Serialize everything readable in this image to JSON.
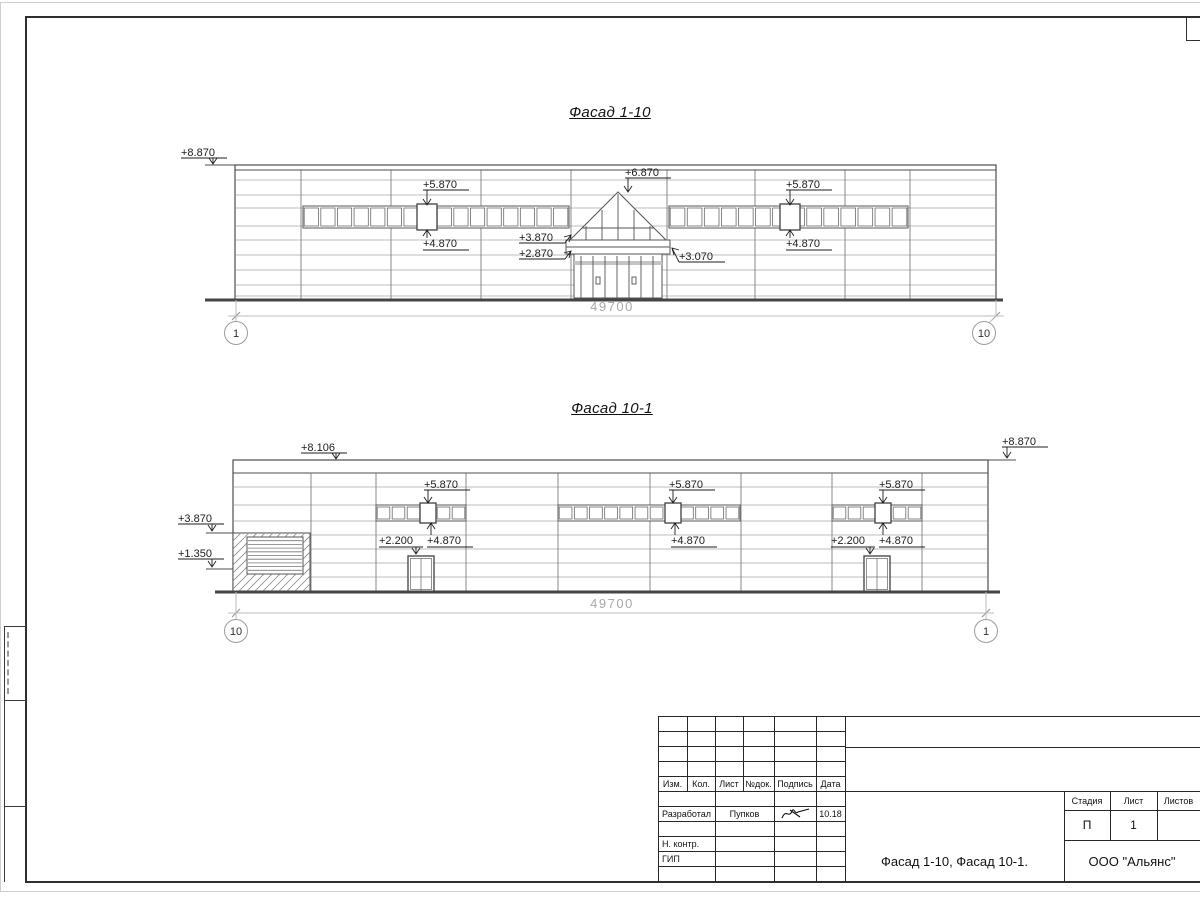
{
  "facade1": {
    "id": "1-10",
    "title": "Фасад 1-10",
    "dim_text": "49700",
    "axis_left": "1",
    "axis_right": "10",
    "wall": {
      "x1": 235,
      "y1": 165,
      "x2": 996,
      "y2": 300
    },
    "parapet_lines": [
      170
    ],
    "hlines": [
      180,
      195,
      208,
      226,
      240,
      255,
      270,
      285,
      296
    ],
    "vlines": [
      301,
      391,
      481,
      571,
      667,
      755,
      845,
      910
    ],
    "vtop": 170,
    "strips": [
      {
        "x1": 303,
        "x2": 569,
        "y1": 206,
        "y2": 228,
        "n": 16,
        "marked": 427
      },
      {
        "x1": 669,
        "x2": 908,
        "y1": 206,
        "y2": 228,
        "n": 14,
        "marked": 790
      }
    ],
    "entrance": {
      "apex": [
        618,
        192
      ],
      "baseY": 240,
      "baseX1": 570,
      "baseX2": 666,
      "canopy": [
        566,
        240,
        670,
        254
      ],
      "canopyLine": 247,
      "store": [
        574,
        254,
        662,
        298
      ],
      "transom": [
        574,
        261,
        662,
        265
      ],
      "mullions": [
        581,
        593,
        605,
        617,
        629,
        641,
        653
      ],
      "handles": [
        [
          596,
          277
        ],
        [
          632,
          277
        ]
      ],
      "glazeVerts": [
        586,
        602,
        618,
        634,
        650
      ],
      "glazeHorizY": 228
    },
    "ground": {
      "x1": 205,
      "x2": 1003,
      "y": 300
    },
    "dim": {
      "y": 316,
      "x1": 236,
      "x2": 996,
      "tx": 612,
      "ty": 311
    },
    "axes": [
      {
        "label": "1",
        "cx": 236,
        "cy": 333,
        "ext": [
          236,
          300,
          236,
          321
        ]
      },
      {
        "label": "10",
        "cx": 984,
        "cy": 333,
        "ext": [
          996,
          300,
          996,
          316
        ],
        "diag": [
          996,
          316,
          987,
          325
        ]
      }
    ],
    "stubs": [
      [
        205,
        165,
        235,
        165
      ]
    ],
    "markers": [
      {
        "label": "+8.870",
        "tx": 181,
        "ty": 156,
        "u": [
          181,
          227,
          158
        ],
        "ax": 213,
        "tip": 164,
        "dir": "down"
      },
      {
        "label": "+5.870",
        "tx": 423,
        "ty": 188,
        "u": [
          423,
          469,
          190
        ],
        "ax": 427,
        "tip": 205,
        "dir": "down"
      },
      {
        "label": "+4.870",
        "tx": 423,
        "ty": 247,
        "u": [
          423,
          469,
          250
        ],
        "ax": 427,
        "tip": 230,
        "dir": "up"
      },
      {
        "label": "+6.870",
        "tx": 625,
        "ty": 176,
        "u": [
          625,
          671,
          178
        ],
        "ax": 628,
        "tip": 192,
        "dir": "down"
      },
      {
        "label": "+3.870",
        "tx": 519,
        "ty": 241,
        "u": [
          519,
          565,
          243
        ],
        "tip": [
          571,
          235
        ],
        "dir": "ne"
      },
      {
        "label": "+2.870",
        "tx": 519,
        "ty": 257,
        "u": [
          519,
          565,
          259
        ],
        "tip": [
          571,
          251
        ],
        "dir": "ne"
      },
      {
        "label": "+3.070",
        "tx": 679,
        "ty": 260,
        "u": [
          679,
          725,
          262
        ],
        "tip": [
          672,
          248
        ],
        "dir": "nw"
      },
      {
        "label": "+5.870",
        "tx": 786,
        "ty": 188,
        "u": [
          786,
          832,
          190
        ],
        "ax": 790,
        "tip": 205,
        "dir": "down"
      },
      {
        "label": "+4.870",
        "tx": 786,
        "ty": 247,
        "u": [
          786,
          832,
          250
        ],
        "ax": 790,
        "tip": 230,
        "dir": "up"
      }
    ]
  },
  "facade2": {
    "id": "10-1",
    "title": "Фасад 10-1",
    "dim_text": "49700",
    "axis_left": "10",
    "axis_right": "1",
    "wall": {
      "x1": 233,
      "y1": 460,
      "x2": 988,
      "y2": 592
    },
    "parapet_lines": [
      473
    ],
    "hlines": [
      487,
      505,
      521,
      535,
      549,
      563,
      577
    ],
    "vlines": [
      311,
      376,
      466,
      558,
      650,
      741,
      832,
      922
    ],
    "vtop": 473,
    "strips": [
      {
        "x1": 376,
        "x2": 466,
        "y1": 505,
        "y2": 521,
        "n": 6,
        "marked": 428
      },
      {
        "x1": 558,
        "x2": 740,
        "y1": 505,
        "y2": 521,
        "n": 12,
        "marked": 673
      },
      {
        "x1": 832,
        "x2": 922,
        "y1": 505,
        "y2": 521,
        "n": 6,
        "marked": 883
      }
    ],
    "hatch": {
      "x1": 233,
      "y1": 533,
      "x2": 310,
      "y2": 592
    },
    "louver": {
      "x1": 247,
      "y1": 537,
      "x2": 303,
      "y2": 574,
      "lines": 10
    },
    "doors": [
      {
        "x1": 408,
        "y1": 556,
        "x2": 434,
        "y2": 592,
        "hline": 577
      },
      {
        "x1": 864,
        "y1": 556,
        "x2": 890,
        "y2": 592,
        "hline": 577
      }
    ],
    "ground": {
      "x1": 215,
      "x2": 1000,
      "y": 592
    },
    "dim": {
      "y": 613,
      "x1": 236,
      "x2": 986,
      "tx": 612,
      "ty": 608
    },
    "axes": [
      {
        "label": "10",
        "cx": 236,
        "cy": 631,
        "ext": [
          236,
          592,
          236,
          619
        ]
      },
      {
        "label": "1",
        "cx": 986,
        "cy": 631,
        "ext": [
          986,
          592,
          986,
          619
        ]
      }
    ],
    "stubs": [
      [
        988,
        460,
        1016,
        460
      ],
      [
        206,
        533,
        233,
        533
      ],
      [
        206,
        569,
        233,
        569
      ]
    ],
    "markers": [
      {
        "label": "+8.106",
        "tx": 301,
        "ty": 451,
        "u": [
          301,
          347,
          453
        ],
        "ax": 336,
        "tip": 459,
        "dir": "down"
      },
      {
        "label": "+8.870",
        "tx": 1002,
        "ty": 445,
        "u": [
          1002,
          1048,
          447
        ],
        "ax": 1007,
        "tip": 458,
        "dir": "down"
      },
      {
        "label": "+3.870",
        "tx": 178,
        "ty": 522,
        "u": [
          178,
          224,
          524
        ],
        "ax": 212,
        "tip": 531,
        "dir": "down"
      },
      {
        "label": "+1.350",
        "tx": 178,
        "ty": 557,
        "u": [
          178,
          224,
          559
        ],
        "ax": 212,
        "tip": 567,
        "dir": "down"
      },
      {
        "label": "+5.870",
        "tx": 424,
        "ty": 488,
        "u": [
          424,
          470,
          490
        ],
        "ax": 428,
        "tip": 503,
        "dir": "down"
      },
      {
        "label": "+5.870",
        "tx": 669,
        "ty": 488,
        "u": [
          669,
          715,
          490
        ],
        "ax": 673,
        "tip": 503,
        "dir": "down"
      },
      {
        "label": "+5.870",
        "tx": 879,
        "ty": 488,
        "u": [
          879,
          925,
          490
        ],
        "ax": 883,
        "tip": 503,
        "dir": "down"
      },
      {
        "label": "+4.870",
        "tx": 427,
        "ty": 544,
        "u": [
          427,
          473,
          547
        ],
        "ax": 431,
        "tip": 523,
        "dir": "up"
      },
      {
        "label": "+4.870",
        "tx": 671,
        "ty": 544,
        "u": [
          671,
          717,
          547
        ],
        "ax": 675,
        "tip": 523,
        "dir": "up"
      },
      {
        "label": "+4.870",
        "tx": 879,
        "ty": 544,
        "u": [
          879,
          925,
          547
        ],
        "ax": 883,
        "tip": 523,
        "dir": "up"
      },
      {
        "label": "+2.200",
        "tx": 379,
        "ty": 544,
        "u": [
          379,
          423,
          547
        ],
        "ax": 416,
        "tip": 554,
        "dir": "down"
      },
      {
        "label": "+2.200",
        "tx": 831,
        "ty": 544,
        "u": [
          831,
          875,
          547
        ],
        "ax": 870,
        "tip": 554,
        "dir": "down"
      }
    ]
  },
  "title_block": {
    "headers": [
      "Изм.",
      "Кол.",
      "Лист",
      "№док.",
      "Подпись",
      "Дата"
    ],
    "developed_label": "Разработал",
    "developer": "Пупков",
    "date": "10.18",
    "ncontr_label": "Н. контр.",
    "gip_label": "ГИП",
    "stage_label": "Стадия",
    "sheet_label": "Лист",
    "sheets_label": "Листов",
    "stage": "П",
    "sheet_no": "1",
    "doc_title": "Фасад 1-10, Фасад 10-1.",
    "company": "ООО \"Альянс\""
  }
}
